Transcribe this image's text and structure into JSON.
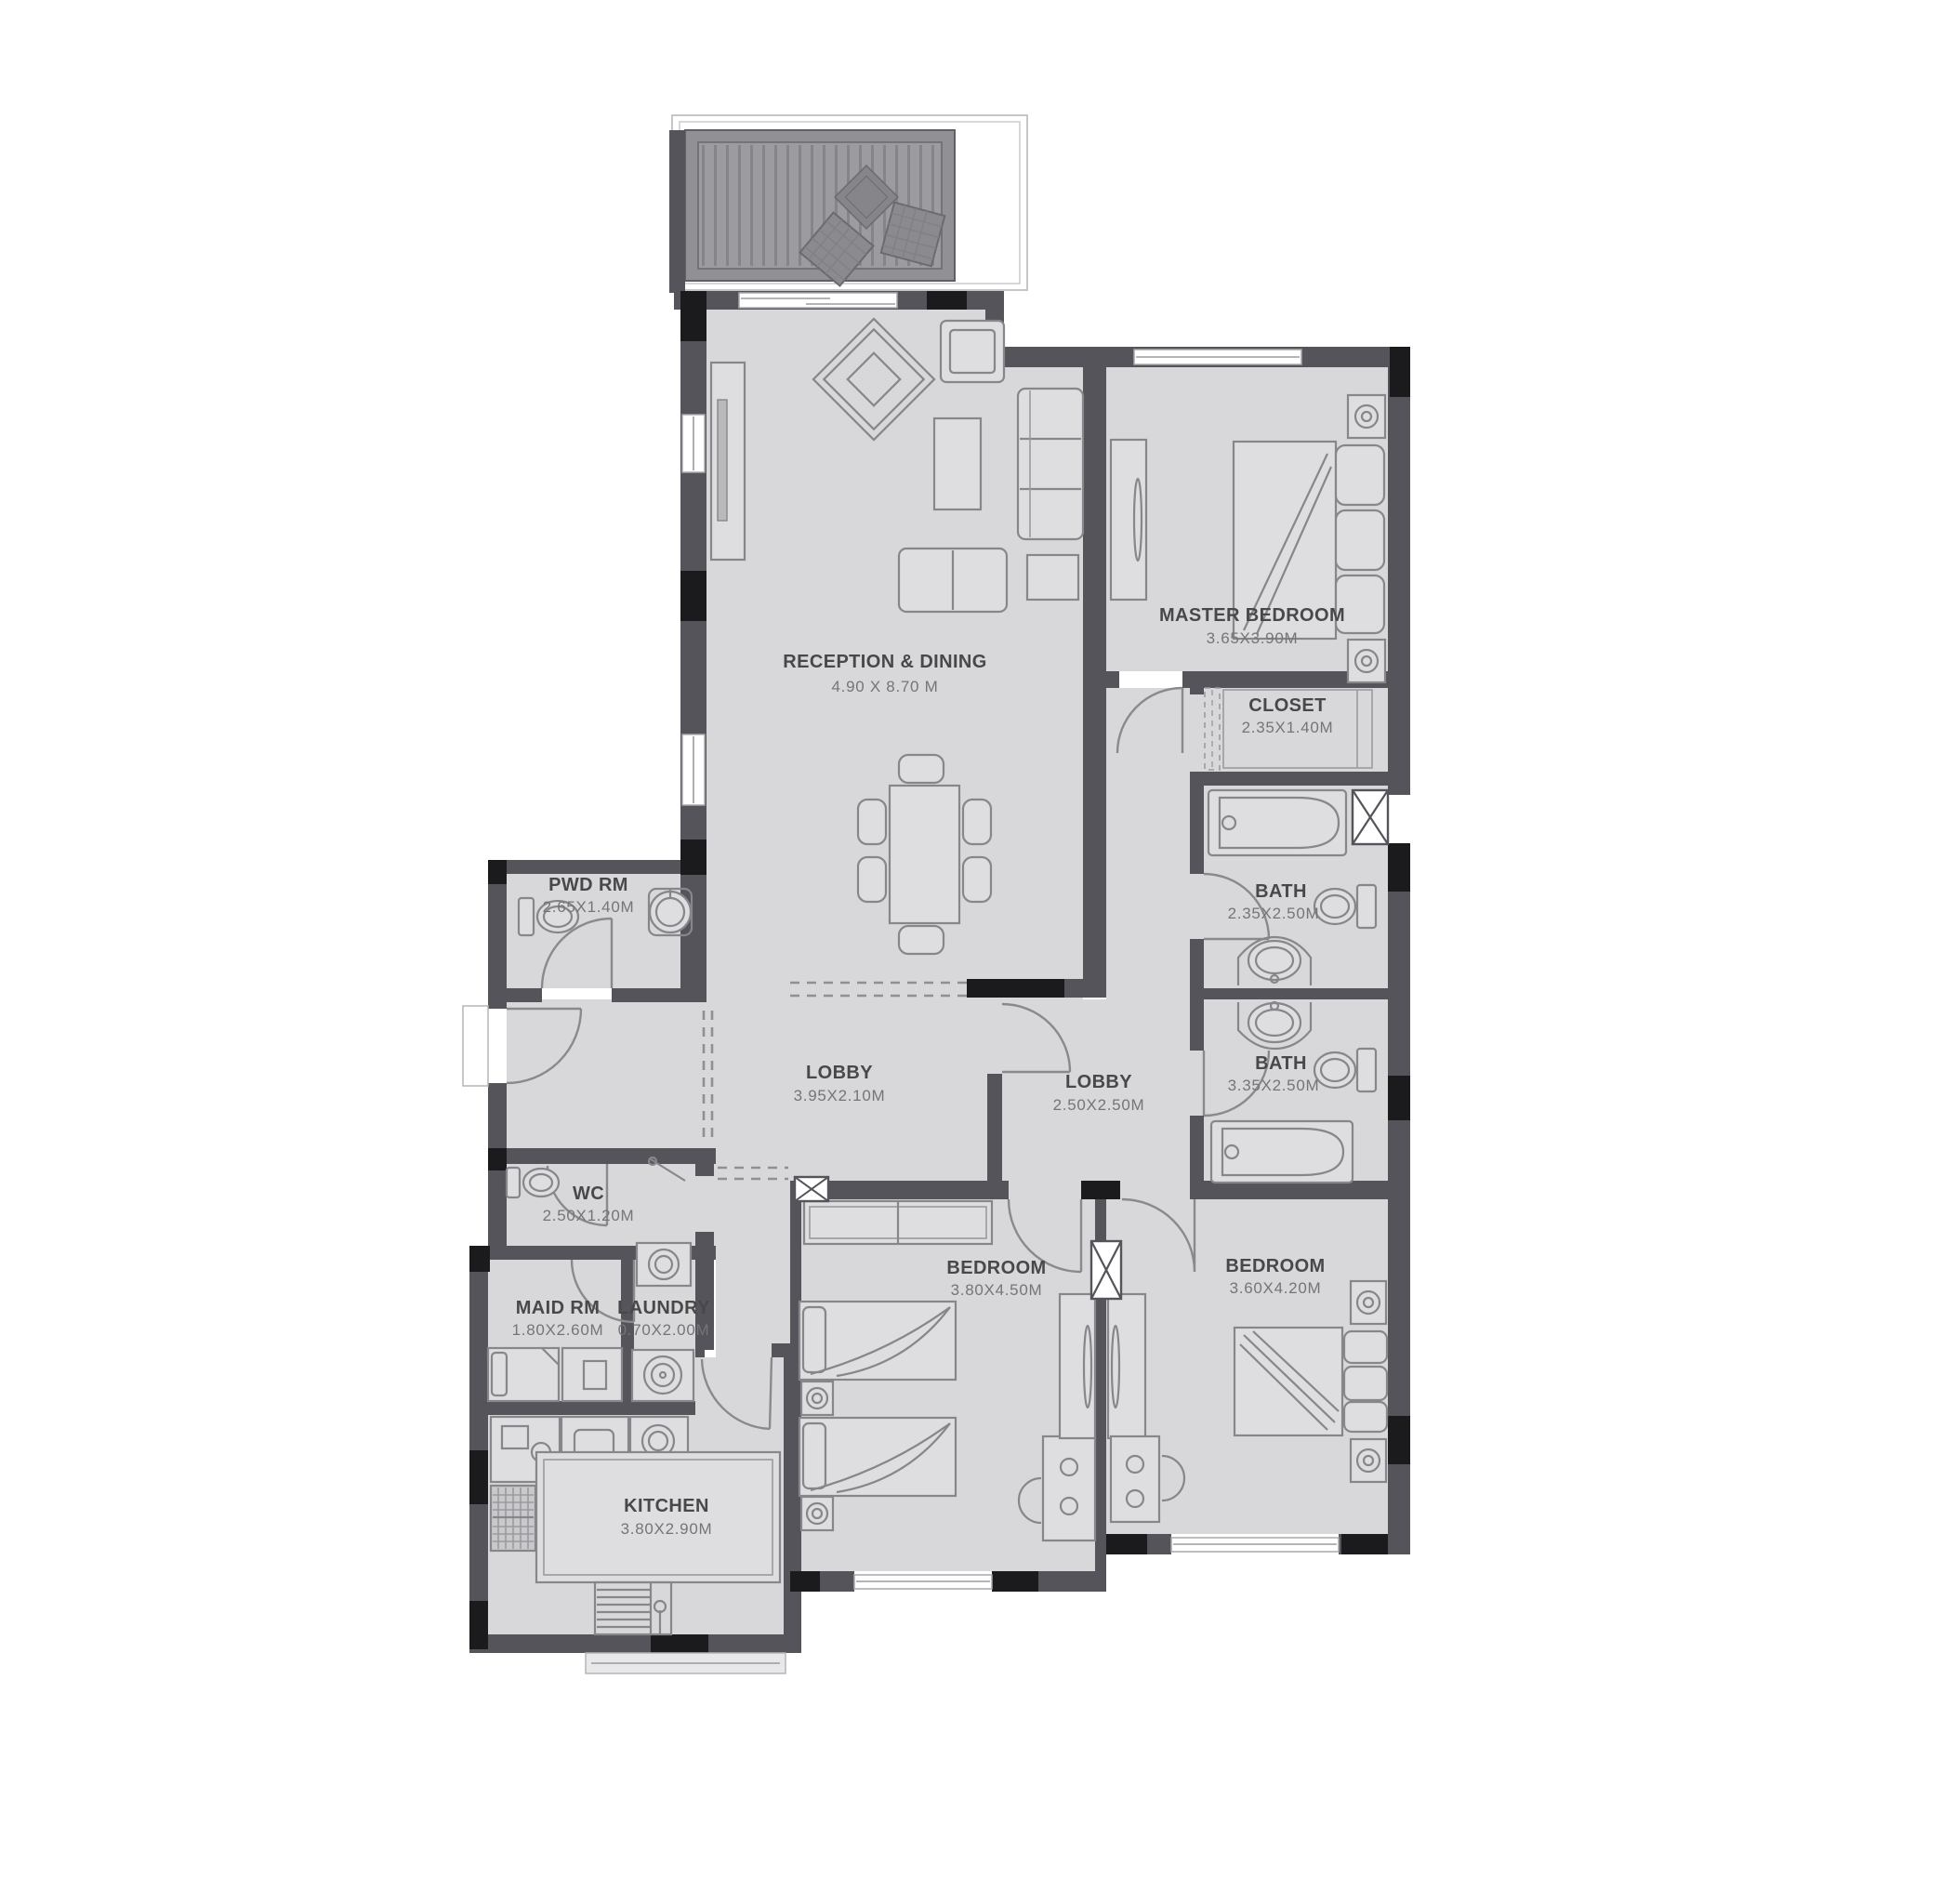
{
  "plan": {
    "type": "apartment-floor-plan",
    "rooms": {
      "reception": {
        "name": "RECEPTION & DINING",
        "dims": "4.90  X  8.70  M"
      },
      "master_bedroom": {
        "name": "MASTER BEDROOM",
        "dims": "3.65X3.90M"
      },
      "closet": {
        "name": "CLOSET",
        "dims": "2.35X1.40M"
      },
      "bath_master": {
        "name": "BATH",
        "dims": "2.35X2.50M"
      },
      "bath_shared": {
        "name": "BATH",
        "dims": "3.35X2.50M"
      },
      "powder_room": {
        "name": "PWD RM",
        "dims": "2.65X1.40M"
      },
      "lobby_main": {
        "name": "LOBBY",
        "dims": "3.95X2.10M"
      },
      "lobby_bedrooms": {
        "name": "LOBBY",
        "dims": "2.50X2.50M"
      },
      "wc": {
        "name": "WC",
        "dims": "2.50X1.20M"
      },
      "maid_room": {
        "name": "MAID RM",
        "dims": "1.80X2.60M"
      },
      "laundry": {
        "name": "LAUNDRY",
        "dims": "0.70X2.00M"
      },
      "bedroom_2": {
        "name": "BEDROOM",
        "dims": "3.80X4.50M"
      },
      "bedroom_3": {
        "name": "BEDROOM",
        "dims": "3.60X4.20M"
      },
      "kitchen": {
        "name": "KITCHEN",
        "dims": "3.80X2.90M"
      }
    },
    "colors": {
      "wall": "#54545a",
      "column_black": "#1b1b1d",
      "floor": "#d8d8da",
      "deck": "#9c9ca0",
      "furniture_line": "#86868b",
      "label_text": "#48484b",
      "dims_text": "#757579",
      "background": "#ffffff"
    }
  }
}
